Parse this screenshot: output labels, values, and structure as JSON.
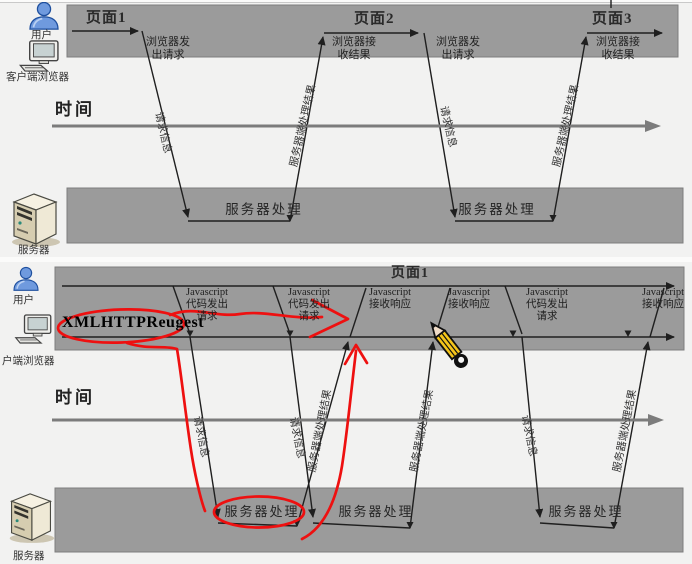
{
  "colors": {
    "bar_gray": "#9b9b9b",
    "panel_bg": "#f2f2f1",
    "line_dark": "#1f1f1f",
    "axis_gray": "#7c7c7c",
    "annotation_red": "#ee1010",
    "pencil_yellow": "#f5c51a",
    "user_blue": "#6f9ade",
    "server_beige": "#e9e2cc"
  },
  "icons": {
    "user": "person-icon",
    "client": "desktop-computer-icon",
    "server": "server-tower-icon",
    "pencil": "pencil-icon"
  },
  "top_diagram": {
    "user_label": "用户",
    "client_label": "客户端浏览器",
    "server_label": "服务器",
    "time_label": "时间",
    "pages": [
      "页面1",
      "页面2",
      "页面3"
    ],
    "actions": [
      "浏览器发\n出请求",
      "浏览器接\n收结果",
      "浏览器发\n出请求",
      "浏览器接\n收结果"
    ],
    "rotated_labels": [
      "请求信息",
      "服务器端处理结果",
      "请求信息",
      "服务器端处理结果"
    ],
    "server_process": [
      "服务器处理",
      "服务器处理"
    ]
  },
  "bottom_diagram": {
    "user_label": "用户",
    "client_label": "户端浏览器",
    "server_label": "服务器",
    "time_label": "时间",
    "page_label": "页面1",
    "xhr_label": "XMLHTTPReugest",
    "js_actions": [
      "Javascript\n代码发出\n请求",
      "Javascript\n代码发出\n请求",
      "Javascript\n接收响应",
      "Javascript\n接收响应",
      "Javascript\n代码发出\n请求",
      "Javascript\n接收响应"
    ],
    "rotated_labels": [
      "请求信息",
      "服务器端处理结果",
      "请求信息",
      "服务器端处理结果",
      "请求信息",
      "服务器端处理结果"
    ],
    "server_process": [
      "服务器处理",
      "服务器处理",
      "服务器处理"
    ]
  }
}
